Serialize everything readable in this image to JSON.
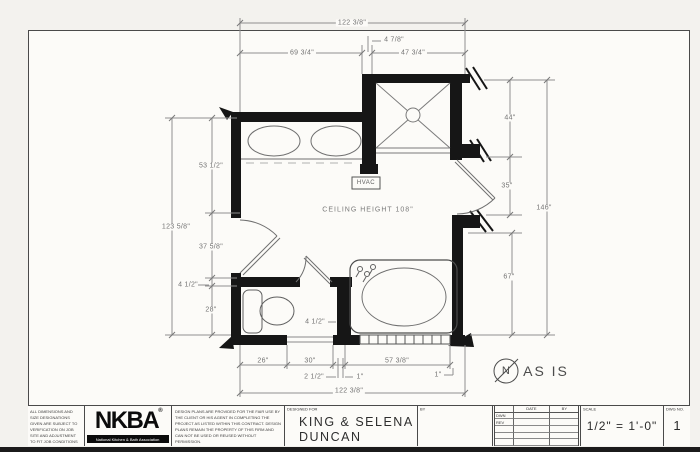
{
  "plan": {
    "ceiling_note": "CEILING HEIGHT 108\"",
    "hvac_label": "HVAC",
    "north_letter": "N",
    "status_note": "AS IS",
    "dims": {
      "top_total": "122 3/8\"",
      "top_offset": "4 7/8\"",
      "top_left": "69 3/4\"",
      "top_right": "47 3/4\"",
      "right_upper": "44\"",
      "right_mid": "35\"",
      "right_total": "146\"",
      "right_lower": "67\"",
      "left_total": "123 5/8\"",
      "left_upper": "53 1/2\"",
      "left_mid": "37 5/8\"",
      "left_small": "4 1/2\"",
      "left_lower": "28\"",
      "bottom_1": "26\"",
      "bottom_2": "30\"",
      "bottom_3": "57 3/8\"",
      "bottom_small_1": "2 1/2\"",
      "bottom_small_2": "1\"",
      "bottom_small_3": "1\"",
      "bottom_total": "122 3/8\"",
      "tub_wall": "4 1/2\""
    }
  },
  "titleblock": {
    "disclaimer_left": "ALL DIMENSIONS AND SIZE DESIGNATIONS GIVEN ARE SUBJECT TO VERIFICATION ON JOB SITE AND ADJUSTMENT TO FIT JOB CONDITIONS",
    "logo_acronym": "NKBA",
    "logo_tm": "®",
    "logo_name": "National Kitchen & Bath Association",
    "disclaimer_center": "DESIGN PLANS ARE PROVIDED FOR THE FAIR USE BY THE CLIENT OR HIS AGENT IN COMPLETING THE PROJECT AS LISTED WITHIN THIS CONTRACT. DESIGN PLANS REMAIN THE PROPERTY OF THIS FIRM AND CAN NOT BE USED OR REUSED WITHOUT PERMISSION.",
    "designed_for_label": "DESIGNED FOR",
    "client_name_line1": "KING & SELENA",
    "client_name_line2": "DUNCAN",
    "by_label": "BY",
    "revision_table": {
      "date_header": "DATE",
      "by_header": "BY",
      "row_drawn": "DWN",
      "row_revised": "REV"
    },
    "scale_label": "SCALE",
    "scale_value": "1/2\" = 1'-0\"",
    "dwg_label": "DWG NO.",
    "dwg_value": "1"
  },
  "colors": {
    "wall": "#161616",
    "dimension_line": "#8f8f8f",
    "paper": "#fcfbf8"
  }
}
